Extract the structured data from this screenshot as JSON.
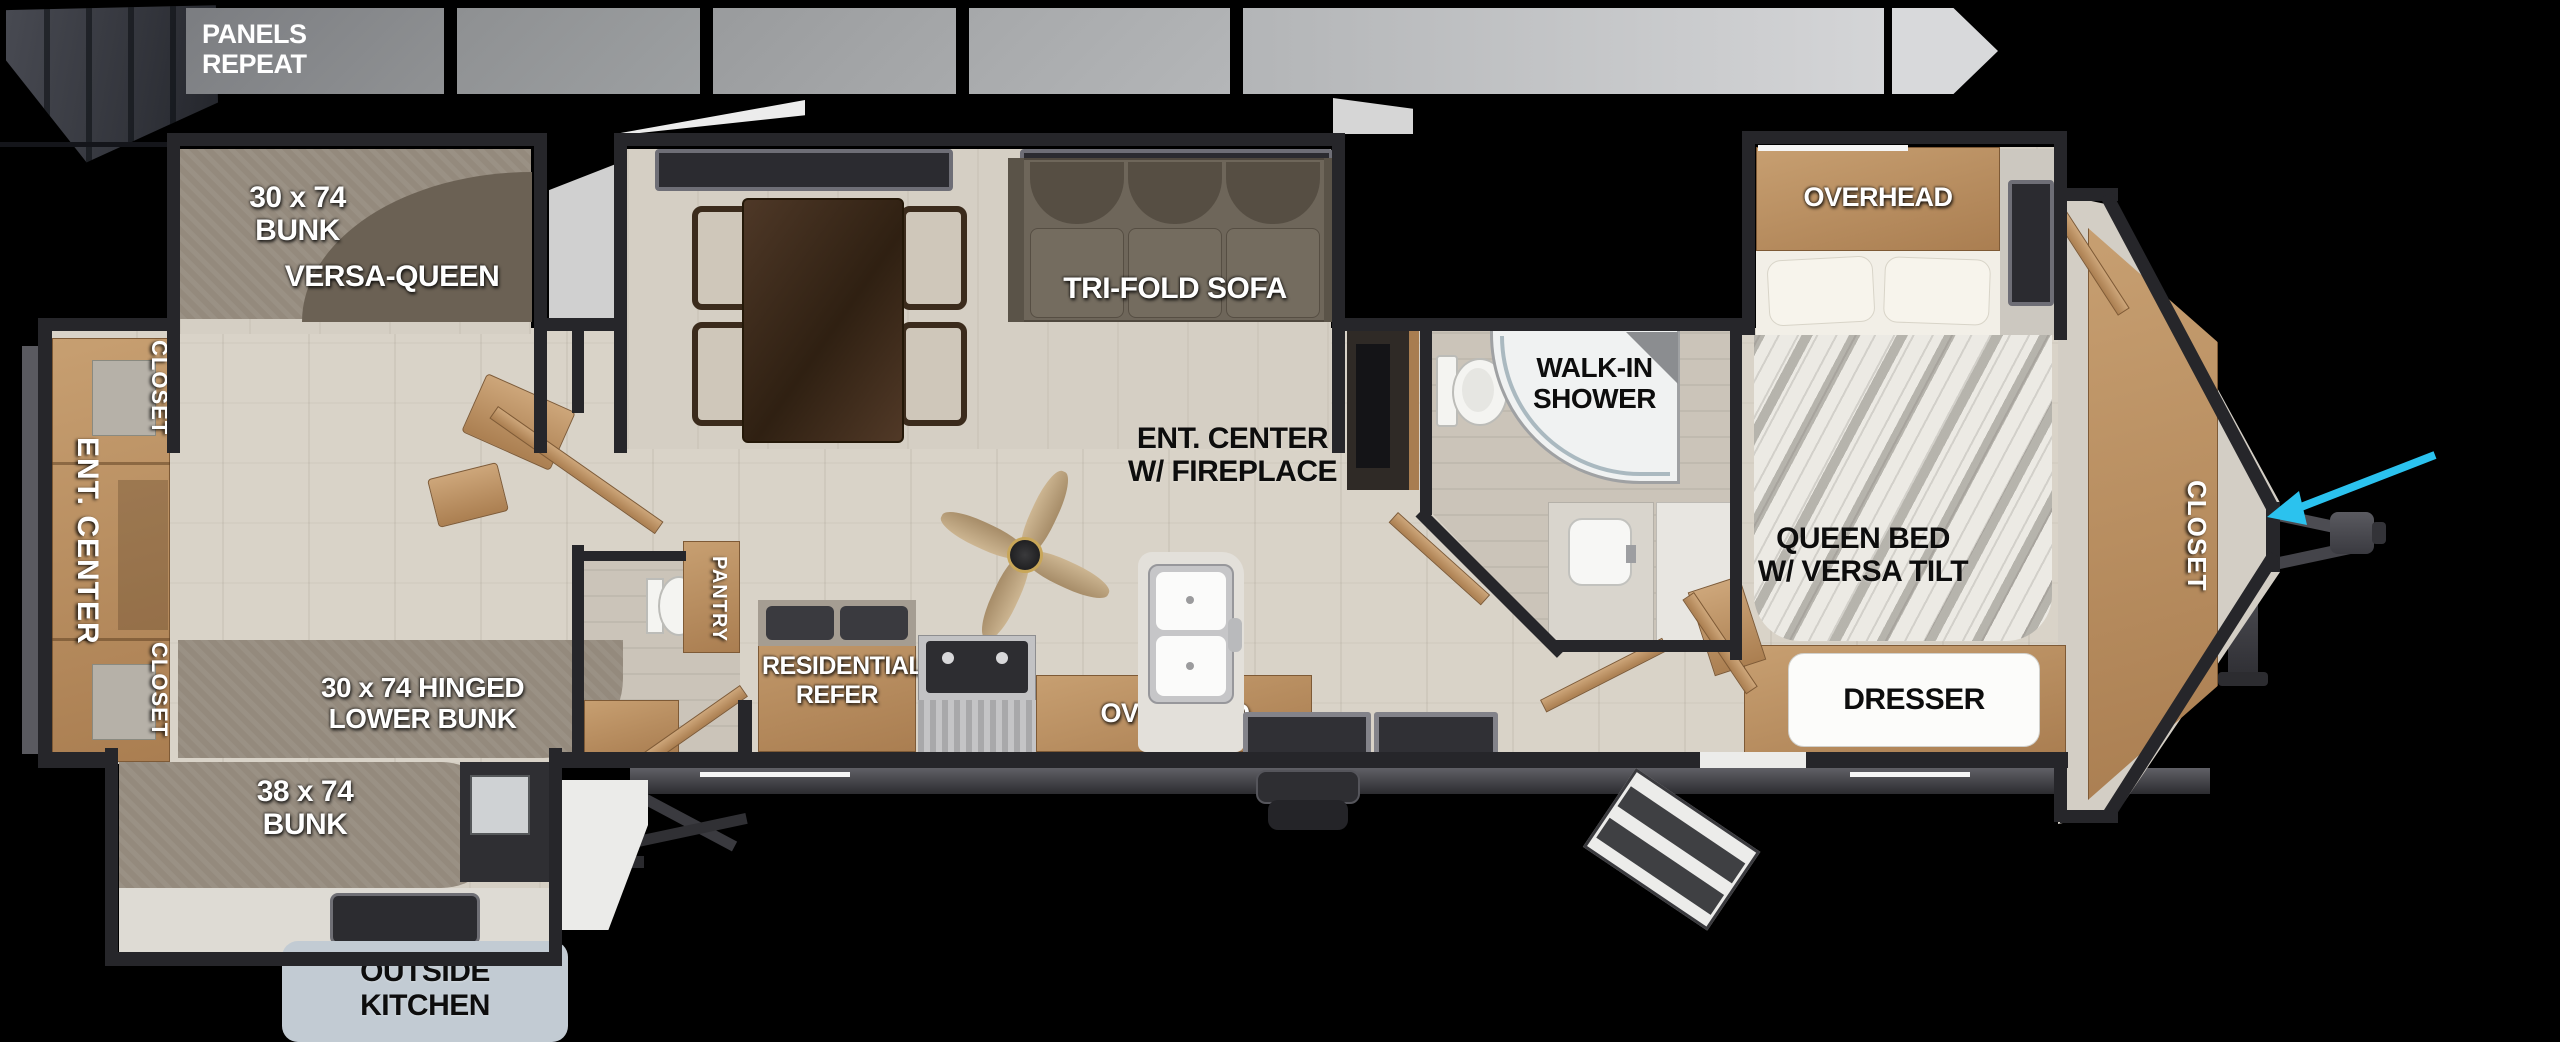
{
  "colors": {
    "arrow": "#2bc2ee",
    "wall": "#26262a",
    "wood": "#bd9166",
    "floor": "#d9d3c8",
    "outside_kitchen_badge": "#c2cbd3"
  },
  "top_strip": {
    "panels_repeat": {
      "line1": "PANELS",
      "line2": "REPEAT"
    }
  },
  "bunk_room": {
    "ent_center": "ENT. CENTER",
    "closet_top": "CLOSET",
    "closet_bottom": "CLOSET",
    "bunk_slide": {
      "line1": "30 x 74",
      "line2": "BUNK",
      "sofa": "VERSA-QUEEN"
    },
    "hinged_bunk": {
      "line1": "30 x 74 HINGED",
      "line2": "LOWER BUNK"
    },
    "lower_slide": {
      "line1": "38 x 74",
      "line2": "BUNK"
    },
    "outside_kitchen": {
      "line1": "OUTSIDE",
      "line2": "KITCHEN"
    }
  },
  "living": {
    "sofa": "TRI-FOLD SOFA",
    "fireplace": {
      "line1": "ENT. CENTER",
      "line2": "W/ FIREPLACE"
    }
  },
  "kitchen": {
    "pantry": "PANTRY",
    "refer": {
      "line1": "RESIDENTIAL",
      "line2": "REFER"
    },
    "overhead": "OVERHEAD"
  },
  "bathroom": {
    "shower": {
      "line1": "WALK-IN",
      "line2": "SHOWER"
    }
  },
  "bedroom": {
    "overhead": "OVERHEAD",
    "bed": {
      "line1": "QUEEN BED",
      "line2": "W/ VERSA TILT"
    },
    "dresser": "DRESSER",
    "closet": "CLOSET"
  }
}
